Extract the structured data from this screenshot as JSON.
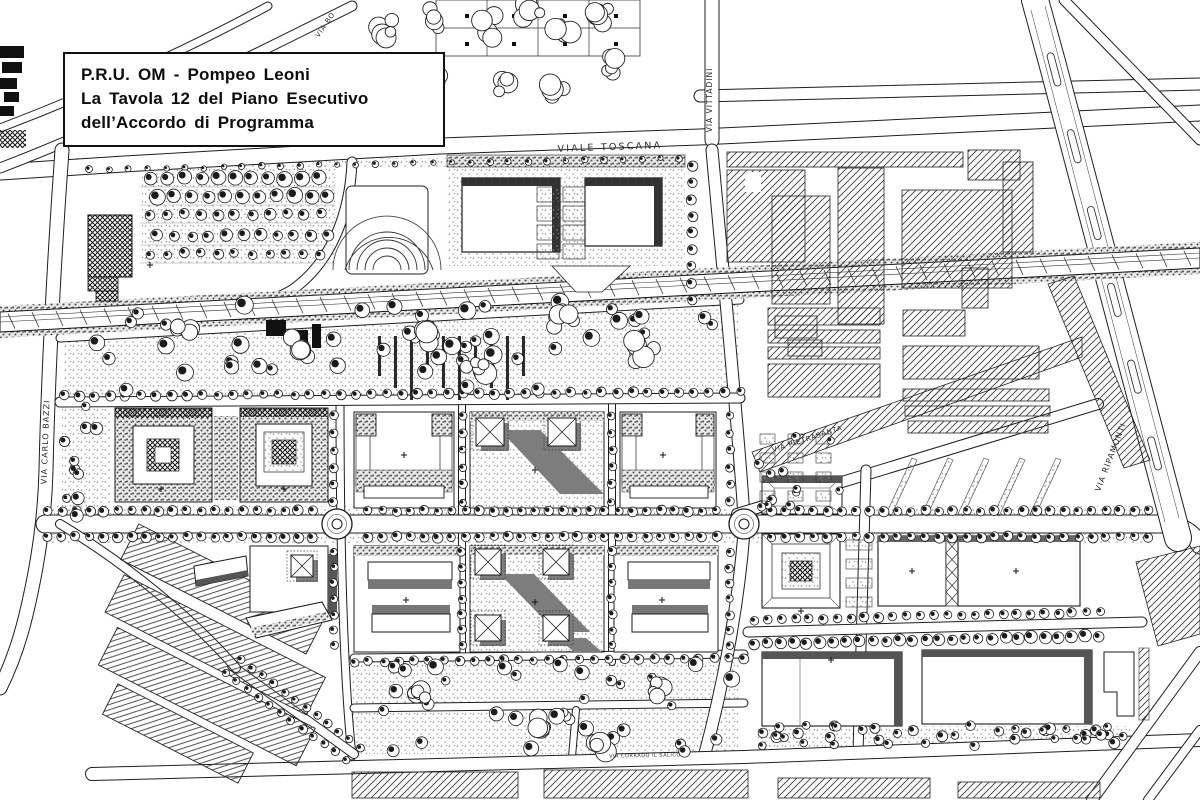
{
  "title_block": {
    "line1": "P.R.U. OM - Pompeo Leoni",
    "line2": "La Tavola 12 del Piano Esecutivo",
    "line3": "dell’Accordo di Programma"
  },
  "street_labels": {
    "viale_toscana": "VIALE TOSCANA",
    "via_vittadini": "VIA VITTADINI",
    "via_bo": "VIA BO",
    "via_carlo_bazzi": "VIA CARLO BAZZI",
    "via_ripamonti": "VIA RIPAMONTI",
    "via_pietrasanta": "VIA PIETRASANTA",
    "via_corrado_il_salico": "VIA CORRADO IL SALICO"
  },
  "colors": {
    "paper": "#ffffff",
    "ink": "#1b1b1b",
    "shadow": "#777777",
    "stipple": "#8e8e8e"
  }
}
